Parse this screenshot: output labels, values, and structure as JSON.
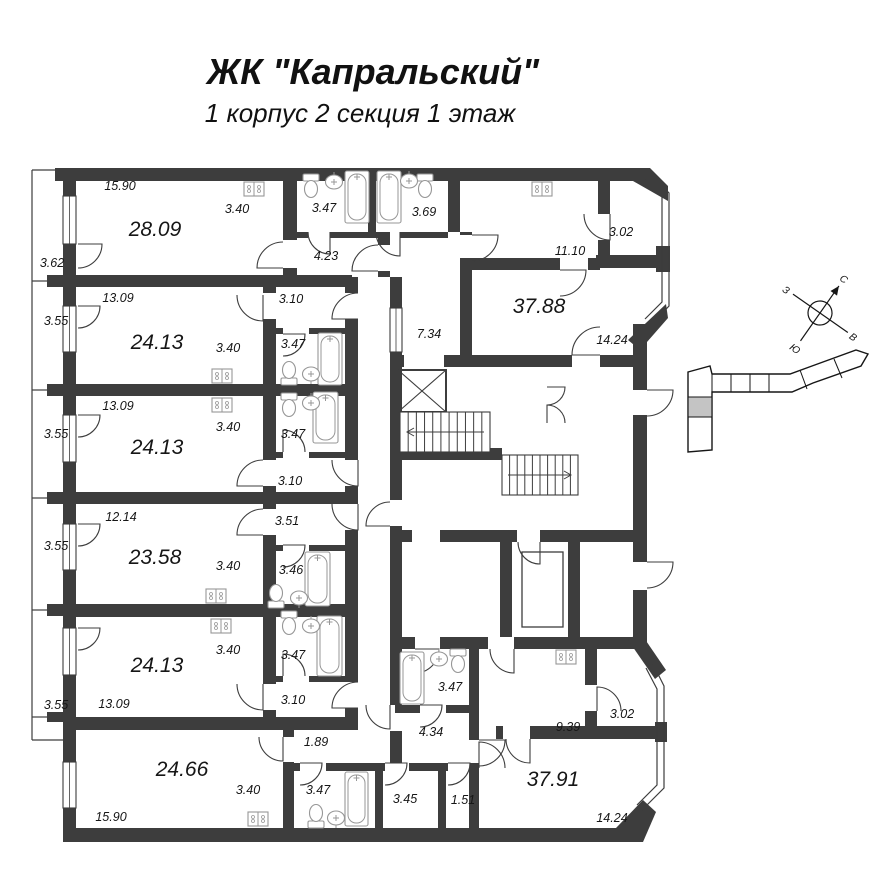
{
  "title": "ЖК \"Капральский\"",
  "subtitle": "1 корпус 2 секция 1 этаж",
  "compass": {
    "north": "С",
    "south": "Ю",
    "east": "В",
    "west": "З"
  },
  "colors": {
    "wall": "#3d3d3d",
    "fixture_outline": "#979797",
    "text": "#161616",
    "minimap_highlight": "#c4c4c4",
    "background": "#ffffff"
  },
  "apartment_areas": [
    "28.09",
    "24.13",
    "24.13",
    "23.58",
    "24.13",
    "24.66",
    "37.88",
    "37.91"
  ],
  "icons": [
    "bathtub-icon",
    "toilet-icon",
    "sink-icon",
    "stove-icon",
    "elevator-icon",
    "stairs-icon",
    "compass-rose",
    "building-minimap"
  ],
  "labels": [
    {
      "text": "15.90",
      "x": 120,
      "y": 186,
      "kind": "dim"
    },
    {
      "text": "3.40",
      "x": 237,
      "y": 209,
      "kind": "dim"
    },
    {
      "text": "28.09",
      "x": 155,
      "y": 229,
      "kind": "area"
    },
    {
      "text": "3.62",
      "x": 52,
      "y": 263,
      "kind": "dim"
    },
    {
      "text": "3.47",
      "x": 324,
      "y": 208,
      "kind": "dim"
    },
    {
      "text": "3.69",
      "x": 424,
      "y": 212,
      "kind": "dim"
    },
    {
      "text": "4.23",
      "x": 326,
      "y": 256,
      "kind": "dim"
    },
    {
      "text": "11.10",
      "x": 570,
      "y": 251,
      "kind": "dim"
    },
    {
      "text": "3.02",
      "x": 621,
      "y": 232,
      "kind": "dim"
    },
    {
      "text": "37.88",
      "x": 539,
      "y": 306,
      "kind": "area"
    },
    {
      "text": "7.34",
      "x": 429,
      "y": 334,
      "kind": "dim"
    },
    {
      "text": "14.24",
      "x": 612,
      "y": 340,
      "kind": "dim"
    },
    {
      "text": "13.09",
      "x": 118,
      "y": 298,
      "kind": "dim"
    },
    {
      "text": "3.55",
      "x": 56,
      "y": 321,
      "kind": "dim"
    },
    {
      "text": "24.13",
      "x": 157,
      "y": 342,
      "kind": "area"
    },
    {
      "text": "3.40",
      "x": 228,
      "y": 348,
      "kind": "dim"
    },
    {
      "text": "3.10",
      "x": 291,
      "y": 299,
      "kind": "dim"
    },
    {
      "text": "3.47",
      "x": 293,
      "y": 344,
      "kind": "dim"
    },
    {
      "text": "13.09",
      "x": 118,
      "y": 406,
      "kind": "dim"
    },
    {
      "text": "3.55",
      "x": 56,
      "y": 434,
      "kind": "dim"
    },
    {
      "text": "24.13",
      "x": 157,
      "y": 447,
      "kind": "area"
    },
    {
      "text": "3.40",
      "x": 228,
      "y": 427,
      "kind": "dim"
    },
    {
      "text": "3.47",
      "x": 293,
      "y": 434,
      "kind": "dim"
    },
    {
      "text": "3.10",
      "x": 290,
      "y": 481,
      "kind": "dim"
    },
    {
      "text": "12.14",
      "x": 121,
      "y": 517,
      "kind": "dim"
    },
    {
      "text": "3.55",
      "x": 56,
      "y": 546,
      "kind": "dim"
    },
    {
      "text": "23.58",
      "x": 155,
      "y": 557,
      "kind": "area"
    },
    {
      "text": "3.40",
      "x": 228,
      "y": 566,
      "kind": "dim"
    },
    {
      "text": "3.51",
      "x": 287,
      "y": 521,
      "kind": "dim"
    },
    {
      "text": "3.46",
      "x": 291,
      "y": 570,
      "kind": "dim"
    },
    {
      "text": "3.40",
      "x": 228,
      "y": 650,
      "kind": "dim"
    },
    {
      "text": "24.13",
      "x": 157,
      "y": 665,
      "kind": "area"
    },
    {
      "text": "3.47",
      "x": 293,
      "y": 655,
      "kind": "dim"
    },
    {
      "text": "13.09",
      "x": 114,
      "y": 704,
      "kind": "dim"
    },
    {
      "text": "3.55",
      "x": 56,
      "y": 705,
      "kind": "dim"
    },
    {
      "text": "3.10",
      "x": 293,
      "y": 700,
      "kind": "dim"
    },
    {
      "text": "1.89",
      "x": 316,
      "y": 742,
      "kind": "dim"
    },
    {
      "text": "24.66",
      "x": 182,
      "y": 769,
      "kind": "area"
    },
    {
      "text": "3.40",
      "x": 248,
      "y": 790,
      "kind": "dim"
    },
    {
      "text": "15.90",
      "x": 111,
      "y": 817,
      "kind": "dim"
    },
    {
      "text": "3.47",
      "x": 318,
      "y": 790,
      "kind": "dim"
    },
    {
      "text": "3.45",
      "x": 405,
      "y": 799,
      "kind": "dim"
    },
    {
      "text": "1.51",
      "x": 463,
      "y": 800,
      "kind": "dim"
    },
    {
      "text": "3.47",
      "x": 450,
      "y": 687,
      "kind": "dim"
    },
    {
      "text": "4.34",
      "x": 431,
      "y": 732,
      "kind": "dim"
    },
    {
      "text": "9.39",
      "x": 568,
      "y": 727,
      "kind": "dim"
    },
    {
      "text": "3.02",
      "x": 622,
      "y": 714,
      "kind": "dim"
    },
    {
      "text": "37.91",
      "x": 553,
      "y": 779,
      "kind": "area"
    },
    {
      "text": "14.24",
      "x": 612,
      "y": 818,
      "kind": "dim"
    }
  ]
}
